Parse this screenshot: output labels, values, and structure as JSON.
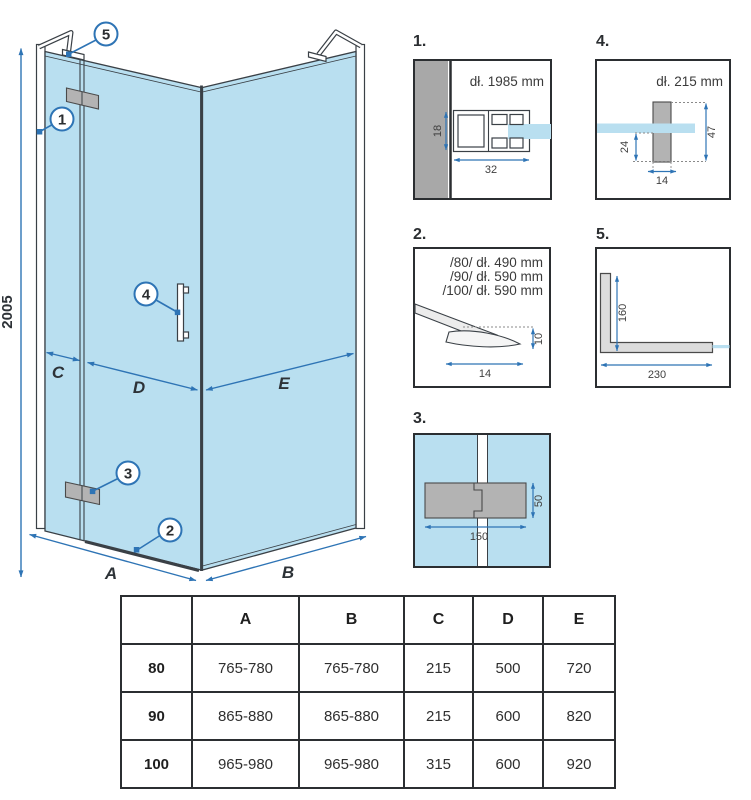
{
  "colors": {
    "accent": "#2e74b5",
    "glass": "#b9dff0",
    "line": "#3a4046",
    "wall_gray": "#a8a8a8"
  },
  "main": {
    "height_dim": "2005",
    "dims": {
      "A": "A",
      "B": "B",
      "C": "C",
      "D": "D",
      "E": "E"
    },
    "callouts": {
      "c1": "1",
      "c2": "2",
      "c3": "3",
      "c4": "4",
      "c5": "5"
    }
  },
  "details": {
    "d1": {
      "label": "1.",
      "title": "dł. 1985 mm",
      "dim_h": "18",
      "dim_w": "32"
    },
    "d2": {
      "label": "2.",
      "line1": "/80/ dł. 490 mm",
      "line2": "/90/ dł. 590 mm",
      "line3": "/100/ dł. 590 mm",
      "dim_w": "14",
      "dim_h": "10"
    },
    "d3": {
      "label": "3.",
      "dim_w": "150",
      "dim_h": "50"
    },
    "d4": {
      "label": "4.",
      "title": "dł. 215 mm",
      "dim_left": "24",
      "dim_right": "47",
      "dim_w": "14"
    },
    "d5": {
      "label": "5.",
      "dim_v": "160",
      "dim_h": "230"
    }
  },
  "table": {
    "headers": [
      "",
      "A",
      "B",
      "C",
      "D",
      "E"
    ],
    "rows": [
      [
        "80",
        "765-780",
        "765-780",
        "215",
        "500",
        "720"
      ],
      [
        "90",
        "865-880",
        "865-880",
        "215",
        "600",
        "820"
      ],
      [
        "100",
        "965-980",
        "965-980",
        "315",
        "600",
        "920"
      ]
    ]
  }
}
